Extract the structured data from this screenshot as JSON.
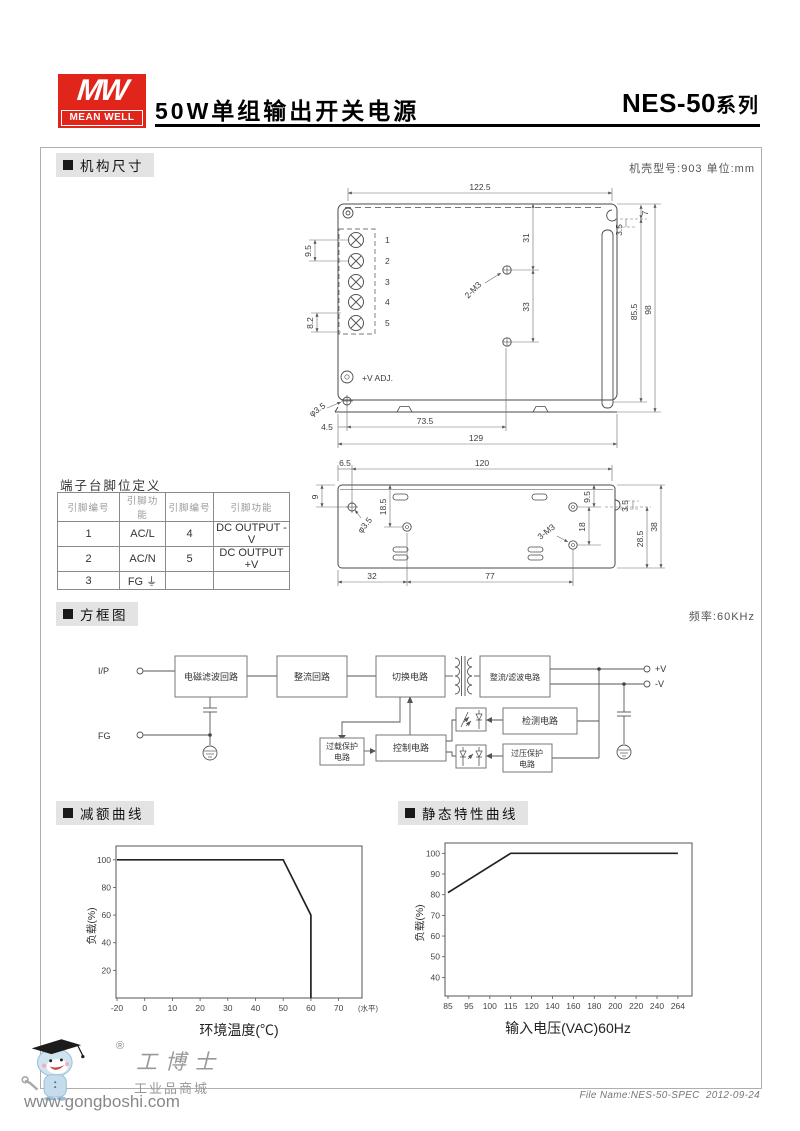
{
  "header": {
    "logo_mw": "MW",
    "logo_brand": "MEAN WELL",
    "brand_color": "#e1251b",
    "title": "50W单组输出开关电源",
    "series": "NES-50",
    "series_suffix": "系列"
  },
  "sections": {
    "mech": "机构尺寸",
    "mech_note": "机壳型号:903  单位:mm",
    "block": "方框图",
    "block_note": "频率:60KHz",
    "derating": "减额曲线",
    "static": "静态特性曲线"
  },
  "drawing_top": {
    "dim_width": "122.5",
    "dim_31": "31",
    "dim_33": "33",
    "screws": "2-M3",
    "dim_9_5": "9.5",
    "dim_8_2": "8.2",
    "dim_7": "7",
    "dim_3_5": "3.5",
    "dim_85_5": "85.5",
    "dim_98": "98",
    "vadj": "+V ADJ.",
    "hole": "φ3.5",
    "dim_4_5": "4.5",
    "dim_73_5": "73.5",
    "dim_129": "129",
    "pins": [
      "1",
      "2",
      "3",
      "4",
      "5"
    ]
  },
  "drawing_bottom": {
    "dim_6_5": "6.5",
    "dim_120": "120",
    "dim_9": "9",
    "dim_18_5": "18.5",
    "hole": "φ3.5",
    "screws": "3-M3",
    "dim_18": "18",
    "dim_9_5": "9.5",
    "dim_3_5": "3.5",
    "dim_28_5": "28.5",
    "dim_38": "38",
    "dim_32": "32",
    "dim_77": "77"
  },
  "terminal_table": {
    "title": "端子台脚位定义",
    "headers": [
      "引脚编号",
      "引脚功能",
      "引脚编号",
      "引脚功能"
    ],
    "rows": [
      [
        "1",
        "AC/L",
        "4",
        "DC OUTPUT -V"
      ],
      [
        "2",
        "AC/N",
        "5",
        "DC OUTPUT +V"
      ],
      [
        "3",
        "FG ⏚",
        "",
        ""
      ]
    ]
  },
  "block_diagram": {
    "ip": "I/P",
    "fg": "FG",
    "emi": "电磁滤波回路",
    "rectifier": "整流回路",
    "switching": "切换电路",
    "out_filter": "整流/滤波电路",
    "overload_1": "过载保护",
    "overload_2": "电路",
    "control": "控制电路",
    "detect": "检测电路",
    "overvolt_1": "过压保护",
    "overvolt_2": "电路",
    "vplus": "+V",
    "vminus": "-V"
  },
  "chart_data": [
    {
      "type": "line",
      "title": "减额曲线",
      "xlabel": "环境温度(℃)",
      "ylabel": "负载(%)",
      "x_tick_labels": [
        "-20",
        "0",
        "10",
        "20",
        "30",
        "40",
        "50",
        "60",
        "70"
      ],
      "x_suffix": "(水平)",
      "y_ticks": [
        20,
        40,
        60,
        80,
        100
      ],
      "ylim": [
        0,
        110
      ],
      "points": [
        [
          -20,
          100
        ],
        [
          50,
          100
        ],
        [
          60,
          60
        ],
        [
          60,
          0
        ]
      ],
      "legend": null,
      "grid": false
    },
    {
      "type": "line",
      "title": "静态特性曲线",
      "xlabel": "输入电压(VAC)60Hz",
      "ylabel": "负载(%)",
      "x_tick_labels": [
        "85",
        "95",
        "100",
        "115",
        "120",
        "140",
        "160",
        "180",
        "200",
        "220",
        "240",
        "264"
      ],
      "y_ticks": [
        40,
        50,
        60,
        70,
        80,
        90,
        100
      ],
      "ylim": [
        31,
        105
      ],
      "points": [
        [
          85,
          81
        ],
        [
          115,
          100
        ],
        [
          264,
          100
        ]
      ],
      "legend": null,
      "grid": false
    }
  ],
  "footer": {
    "reg": "®",
    "brand": "工博士",
    "sub": "工业品商城",
    "url": "www.gongboshi.com",
    "file": "File Name:NES-50-SPEC",
    "date": "2012-09-24"
  }
}
